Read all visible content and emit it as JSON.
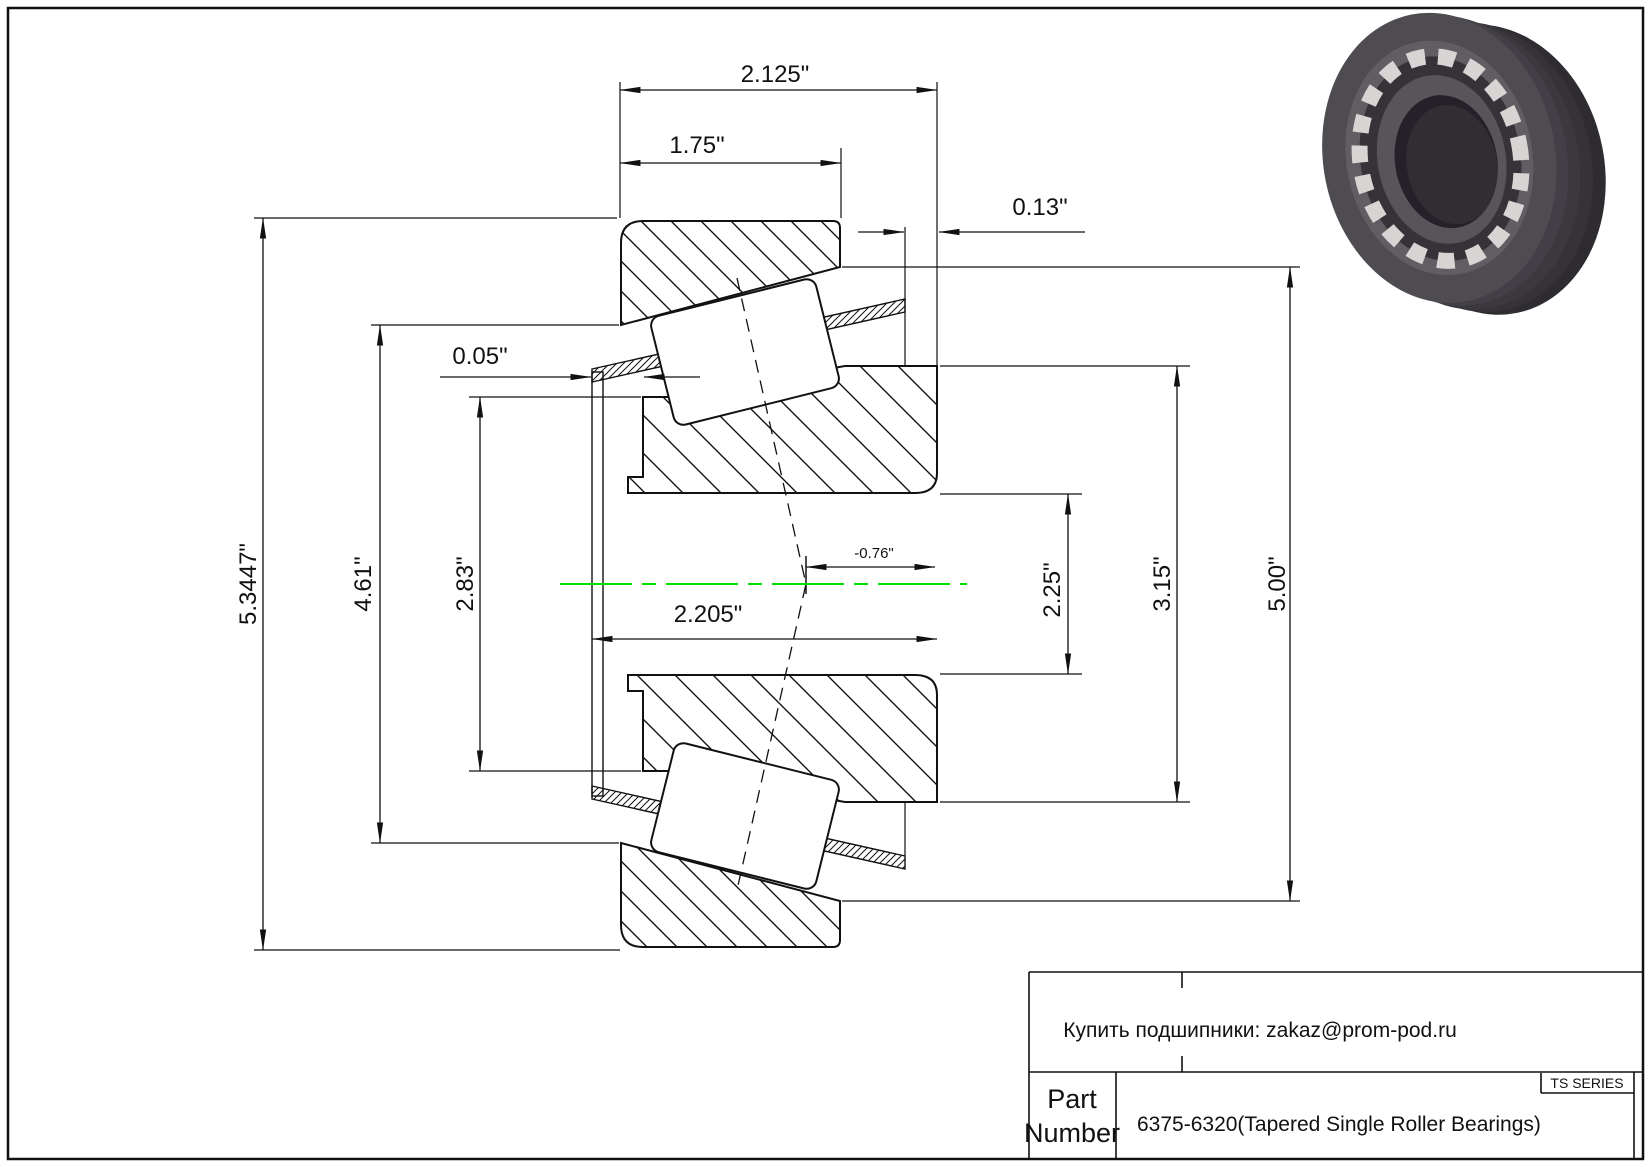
{
  "drawing": {
    "kind": "tapered-roller-bearing-cross-section",
    "colors": {
      "line": "#111111",
      "centerline_green": "#00dd00",
      "background": "#ffffff"
    },
    "dims": {
      "d2125": "2.125\"",
      "d175": "1.75\"",
      "d013": "0.13\"",
      "d005": "0.05\"",
      "d53447": "5.3447\"",
      "d461": "4.61\"",
      "d283": "2.83\"",
      "d2205": "2.205\"",
      "dneg076": "-0.76\"",
      "d225": "2.25\"",
      "d315": "3.15\"",
      "d500": "5.00\""
    }
  },
  "title_block": {
    "contact": "Купить подшипники: zakaz@prom-pod.ru",
    "part_label_line1": "Part",
    "part_label_line2": "Number",
    "part_number": "6375-6320(Tapered Single Roller Bearings)",
    "series": "TS SERIES"
  }
}
